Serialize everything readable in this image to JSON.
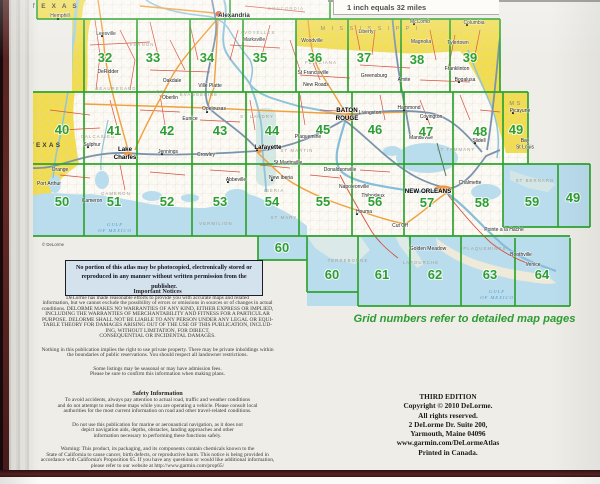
{
  "page": {
    "scale_label": "1 inch equals 32 miles",
    "grid_note": "Grid numbers refer to detailed map pages",
    "notice_box": "No portion of this atlas may be photocopied, electronically stored or reproduced in any manner without written permission from the publisher.",
    "map_copyright": "© DeLorme"
  },
  "legal": {
    "important_title": "Important Notices",
    "important_paragraphs": [
      [
        "DeLorme has made reasonable efforts to provide you with accurate maps and related",
        "information, but we cannot exclude the possibility of errors or omissions in sources or of changes in actual",
        "conditions. DELORME MAKES NO WARRANTIES OF ANY KIND, EITHER EXPRESS OR IMPLIED,",
        "INCLUDING THE WARRANTIES OF MERCHANTABILITY AND FITNESS FOR A PARTICULAR",
        "PURPOSE. DELORME SHALL NOT BE LIABLE TO ANY PERSON UNDER ANY LEGAL OR EQUI-",
        "TABLE THEORY FOR DAMAGES ARISING OUT OF THE USE OF THIS PUBLICATION, INCLUD-",
        "ING, WITHOUT LIMITATION, FOR DIRECT,",
        "CONSEQUENTIAL OR INCIDENTAL DAMAGES."
      ],
      [
        "Nothing in this publication implies the right to use private property. There may be private inholdings within",
        "the boundaries of public reservations. You should respect all landowner restrictions."
      ],
      [
        "Some listings may be seasonal or may have admission fees.",
        "Please be sure to confirm this information when making plans."
      ]
    ],
    "safety_title": "Safety Information",
    "safety_paragraphs": [
      [
        "To avoid accidents, always pay attention to actual road, traffic and weather conditions",
        "and do not attempt to read these maps while you are operating a vehicle. Please consult local",
        "authorities for the most current information on road and other travel-related conditions."
      ],
      [
        "Do not use this publication for marine or aeronautical navigation, as it does not",
        "depict navigation aids, depths, obstacles, landing approaches and other",
        "information necessary to performing these functions safely."
      ],
      [
        "Warning: This product, its packaging, and its components contain chemicals known to the",
        "State of California to cause cancer, birth defects, or reproductive harm. This notice is being provided in",
        "accordance with California's Proposition 65. If you have any questions or would like additional information,",
        "please refer to our website at http://www.garmin.com/prop65/"
      ]
    ]
  },
  "edition": {
    "lines": [
      "THIRD EDITION",
      "Copyright © 2010 DeLorme.",
      "All rights reserved.",
      "2 DeLorme Dr. Suite 200,",
      "Yarmouth, Maine 04096",
      "www.garmin.com/DeLormeAtlas",
      "Printed in Canada."
    ]
  },
  "map": {
    "grid_numbers": [
      {
        "t": "32",
        "x": 105,
        "y": 62
      },
      {
        "t": "33",
        "x": 153,
        "y": 62
      },
      {
        "t": "34",
        "x": 207,
        "y": 62
      },
      {
        "t": "35",
        "x": 260,
        "y": 62
      },
      {
        "t": "36",
        "x": 315,
        "y": 62
      },
      {
        "t": "37",
        "x": 364,
        "y": 62
      },
      {
        "t": "38",
        "x": 417,
        "y": 64
      },
      {
        "t": "39",
        "x": 470,
        "y": 62
      },
      {
        "t": "40",
        "x": 62,
        "y": 134
      },
      {
        "t": "41",
        "x": 114,
        "y": 135
      },
      {
        "t": "42",
        "x": 167,
        "y": 135
      },
      {
        "t": "43",
        "x": 220,
        "y": 135
      },
      {
        "t": "44",
        "x": 272,
        "y": 135
      },
      {
        "t": "45",
        "x": 323,
        "y": 134
      },
      {
        "t": "46",
        "x": 375,
        "y": 134
      },
      {
        "t": "47",
        "x": 426,
        "y": 136
      },
      {
        "t": "48",
        "x": 480,
        "y": 136
      },
      {
        "t": "49",
        "x": 516,
        "y": 134
      },
      {
        "t": "50",
        "x": 62,
        "y": 206
      },
      {
        "t": "51",
        "x": 114,
        "y": 206
      },
      {
        "t": "52",
        "x": 167,
        "y": 206
      },
      {
        "t": "53",
        "x": 220,
        "y": 206
      },
      {
        "t": "54",
        "x": 272,
        "y": 206
      },
      {
        "t": "55",
        "x": 323,
        "y": 206
      },
      {
        "t": "56",
        "x": 375,
        "y": 206
      },
      {
        "t": "57",
        "x": 427,
        "y": 207
      },
      {
        "t": "58",
        "x": 482,
        "y": 207
      },
      {
        "t": "59",
        "x": 532,
        "y": 206
      },
      {
        "t": "49",
        "x": 573,
        "y": 202
      },
      {
        "t": "60",
        "x": 282,
        "y": 252
      },
      {
        "t": "60",
        "x": 332,
        "y": 279
      },
      {
        "t": "61",
        "x": 382,
        "y": 279
      },
      {
        "t": "62",
        "x": 435,
        "y": 279
      },
      {
        "t": "63",
        "x": 490,
        "y": 279
      },
      {
        "t": "64",
        "x": 542,
        "y": 279
      }
    ],
    "states": [
      {
        "t": "T E X A S",
        "x": 55,
        "y": 8,
        "s": "state"
      },
      {
        "t": "TEXAS",
        "x": 46,
        "y": 147,
        "s": "state"
      },
      {
        "t": "M I S S I S S I P P I",
        "x": 370,
        "y": 30,
        "s": "statems"
      },
      {
        "t": "MS",
        "x": 516,
        "y": 105,
        "s": "statems"
      }
    ],
    "cities_bold": [
      {
        "t": "Alexandria",
        "x": 234,
        "y": 17
      },
      {
        "lines": [
          "BATON",
          "ROUGE"
        ],
        "x": 347,
        "y": 112
      },
      {
        "t": "NEW ORLEANS",
        "x": 428,
        "y": 193
      },
      {
        "t": "Lafayette",
        "x": 268,
        "y": 149
      },
      {
        "lines": [
          "Lake",
          "Charles"
        ],
        "x": 125,
        "y": 151
      }
    ],
    "cities": [
      {
        "t": "Hemphill",
        "x": 60,
        "y": 17
      },
      {
        "t": "Leesville",
        "x": 106,
        "y": 35
      },
      {
        "t": "Marksville",
        "x": 254,
        "y": 41
      },
      {
        "t": "Ville Platte",
        "x": 210,
        "y": 87
      },
      {
        "t": "Oakdale",
        "x": 172,
        "y": 82
      },
      {
        "t": "Oberlin",
        "x": 170,
        "y": 99
      },
      {
        "t": "Opelousas",
        "x": 214,
        "y": 110
      },
      {
        "t": "DeRidder",
        "x": 108,
        "y": 73
      },
      {
        "t": "Sulphur",
        "x": 92,
        "y": 146
      },
      {
        "t": "Jennings",
        "x": 168,
        "y": 153
      },
      {
        "t": "Crowley",
        "x": 206,
        "y": 156
      },
      {
        "t": "Eunice",
        "x": 190,
        "y": 120
      },
      {
        "t": "Orange",
        "x": 60,
        "y": 171
      },
      {
        "t": "Port Arthur",
        "x": 49,
        "y": 185
      },
      {
        "t": "Cameron",
        "x": 92,
        "y": 202
      },
      {
        "t": "Abbeville",
        "x": 236,
        "y": 181
      },
      {
        "t": "New Iberia",
        "x": 281,
        "y": 179
      },
      {
        "t": "St Martinville",
        "x": 288,
        "y": 164
      },
      {
        "t": "New Roads",
        "x": 316,
        "y": 86
      },
      {
        "t": "St Francisville",
        "x": 313,
        "y": 74
      },
      {
        "t": "Plaquemine",
        "x": 308,
        "y": 138
      },
      {
        "t": "Livingston",
        "x": 370,
        "y": 114
      },
      {
        "t": "Donaldsonville",
        "x": 340,
        "y": 171
      },
      {
        "t": "Napoleonville",
        "x": 354,
        "y": 188
      },
      {
        "t": "Thibodaux",
        "x": 373,
        "y": 197
      },
      {
        "t": "Houma",
        "x": 364,
        "y": 213
      },
      {
        "t": "Cut Off",
        "x": 400,
        "y": 227
      },
      {
        "t": "Golden Meadow",
        "x": 428,
        "y": 250
      },
      {
        "t": "Hammond",
        "x": 409,
        "y": 109
      },
      {
        "t": "Covington",
        "x": 431,
        "y": 118
      },
      {
        "t": "Mandeville",
        "x": 421,
        "y": 139
      },
      {
        "t": "Amite",
        "x": 404,
        "y": 81
      },
      {
        "t": "Greensburg",
        "x": 374,
        "y": 77
      },
      {
        "t": "Franklinton",
        "x": 457,
        "y": 70
      },
      {
        "t": "Bogalusa",
        "x": 465,
        "y": 81
      },
      {
        "t": "Slidell",
        "x": 479,
        "y": 142
      },
      {
        "t": "Chalmette",
        "x": 470,
        "y": 184
      },
      {
        "t": "Picayune",
        "x": 520,
        "y": 112
      },
      {
        "lines": [
          "Bay",
          "St Louis"
        ],
        "x": 525,
        "y": 142
      },
      {
        "t": "Woodville",
        "x": 312,
        "y": 42
      },
      {
        "t": "Liberty",
        "x": 366,
        "y": 33
      },
      {
        "t": "McComb",
        "x": 420,
        "y": 23
      },
      {
        "t": "Magnolia",
        "x": 421,
        "y": 43
      },
      {
        "t": "Tylertown",
        "x": 458,
        "y": 44
      },
      {
        "t": "Columbia",
        "x": 474,
        "y": 24
      },
      {
        "t": "Pointe a la Hache",
        "x": 504,
        "y": 231
      },
      {
        "t": "Boothville",
        "x": 521,
        "y": 256
      },
      {
        "t": "Venice",
        "x": 533,
        "y": 266
      }
    ],
    "parishes": [
      {
        "t": "VERNON",
        "x": 142,
        "y": 46
      },
      {
        "t": "AVOYELLES",
        "x": 258,
        "y": 34
      },
      {
        "t": "CONCORDIA",
        "x": 286,
        "y": 10
      },
      {
        "t": "BEAUREGARD",
        "x": 116,
        "y": 90
      },
      {
        "t": "ALLEN",
        "x": 155,
        "y": 93
      },
      {
        "t": "EVANGELINE",
        "x": 199,
        "y": 96
      },
      {
        "t": "ST LANDRY",
        "x": 257,
        "y": 118
      },
      {
        "t": "CALCASIEU",
        "x": 98,
        "y": 138
      },
      {
        "t": "FELICIANA",
        "x": 321,
        "y": 64
      },
      {
        "t": "CAMERON",
        "x": 116,
        "y": 195
      },
      {
        "t": "VERMILION",
        "x": 216,
        "y": 225
      },
      {
        "t": "IBERIA",
        "x": 274,
        "y": 192
      },
      {
        "t": "ST MARY",
        "x": 284,
        "y": 219
      },
      {
        "t": "ST MARTIN",
        "x": 297,
        "y": 152
      },
      {
        "t": "ST TAMMANY",
        "x": 456,
        "y": 151
      },
      {
        "t": "TERREBONNE",
        "x": 348,
        "y": 262
      },
      {
        "t": "LAFOURCHE",
        "x": 421,
        "y": 264
      },
      {
        "t": "PLAQUEMINES",
        "x": 485,
        "y": 250
      },
      {
        "t": "ST BERNARD",
        "x": 535,
        "y": 182
      }
    ],
    "water_labels": [
      {
        "lines": [
          "GULF",
          "OF MEXICO"
        ],
        "x": 115,
        "y": 226
      },
      {
        "lines": [
          "GULF",
          "OF MEXICO"
        ],
        "x": 497,
        "y": 293
      }
    ],
    "dots": [
      [
        219,
        15
      ],
      [
        257,
        150
      ],
      [
        352,
        119
      ],
      [
        441,
        191
      ],
      [
        129,
        155
      ],
      [
        404,
        110
      ],
      [
        357,
        214
      ],
      [
        207,
        112
      ],
      [
        272,
        180
      ],
      [
        228,
        182
      ],
      [
        459,
        82
      ],
      [
        513,
        113
      ],
      [
        414,
        24
      ],
      [
        467,
        25
      ],
      [
        58,
        19
      ],
      [
        102,
        36
      ],
      [
        88,
        147
      ],
      [
        162,
        154
      ],
      [
        427,
        119
      ],
      [
        475,
        143
      ]
    ]
  },
  "colors": {
    "grid_green": "#2fa32f",
    "number_green": "#2d9e32",
    "state_yellow": "#f1dd4e",
    "water_blue": "#badded",
    "interstate": "#7b93ac",
    "us_highway": "#f0a03c",
    "local_road": "#d8503d",
    "book_edge": "#562523",
    "notice_bg": "#d4e2ee"
  }
}
